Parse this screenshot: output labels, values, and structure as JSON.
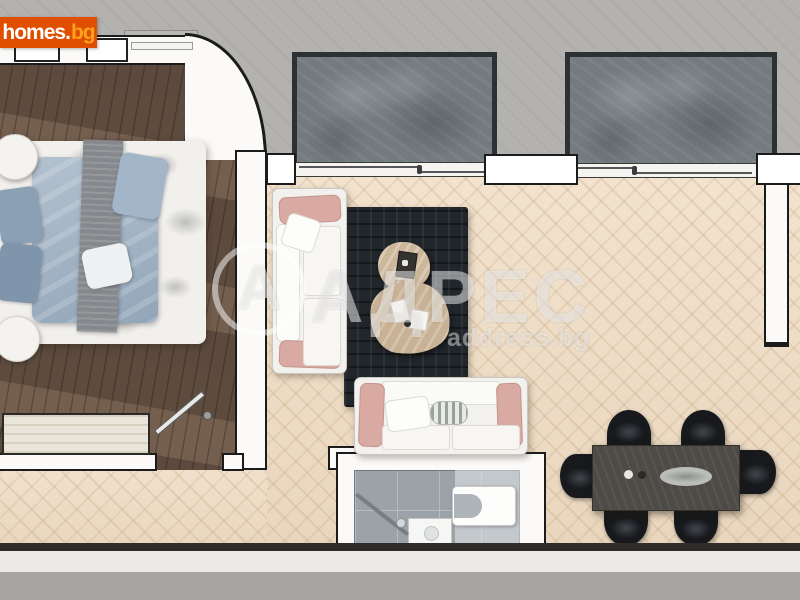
{
  "branding": {
    "logo_primary": "homes",
    "logo_dot": ".",
    "logo_suffix": "bg"
  },
  "watermark": {
    "monogram": "А",
    "agency": "АДРЕС",
    "domain": "address.bg"
  },
  "colors": {
    "logo_background": "#e04e00",
    "logo_text": "#ffffff",
    "logo_suffix": "#ffa11c",
    "watermark_white": "rgba(255,255,255,0.48)",
    "wall_fill": "#fbfaf8",
    "wall_outline": "#1b1b1b",
    "exterior_gray": "#b4b2af",
    "parquet_living": "#eddcc6",
    "bedroom_wood": "#6f5b4c",
    "balcony_stone": "#747b7f",
    "rug_dark": "#21262b",
    "sofa_white": "#f2f1ee",
    "sofa_pink_pillow": "#d9aaa1",
    "bed_duvet_blue": "#9fb2c4",
    "coffee_table_beige": "#cdb79b",
    "bath_tile_gray": "#9ba3a9",
    "dining_table": "#4e4b46",
    "chair_black": "#17191c"
  }
}
